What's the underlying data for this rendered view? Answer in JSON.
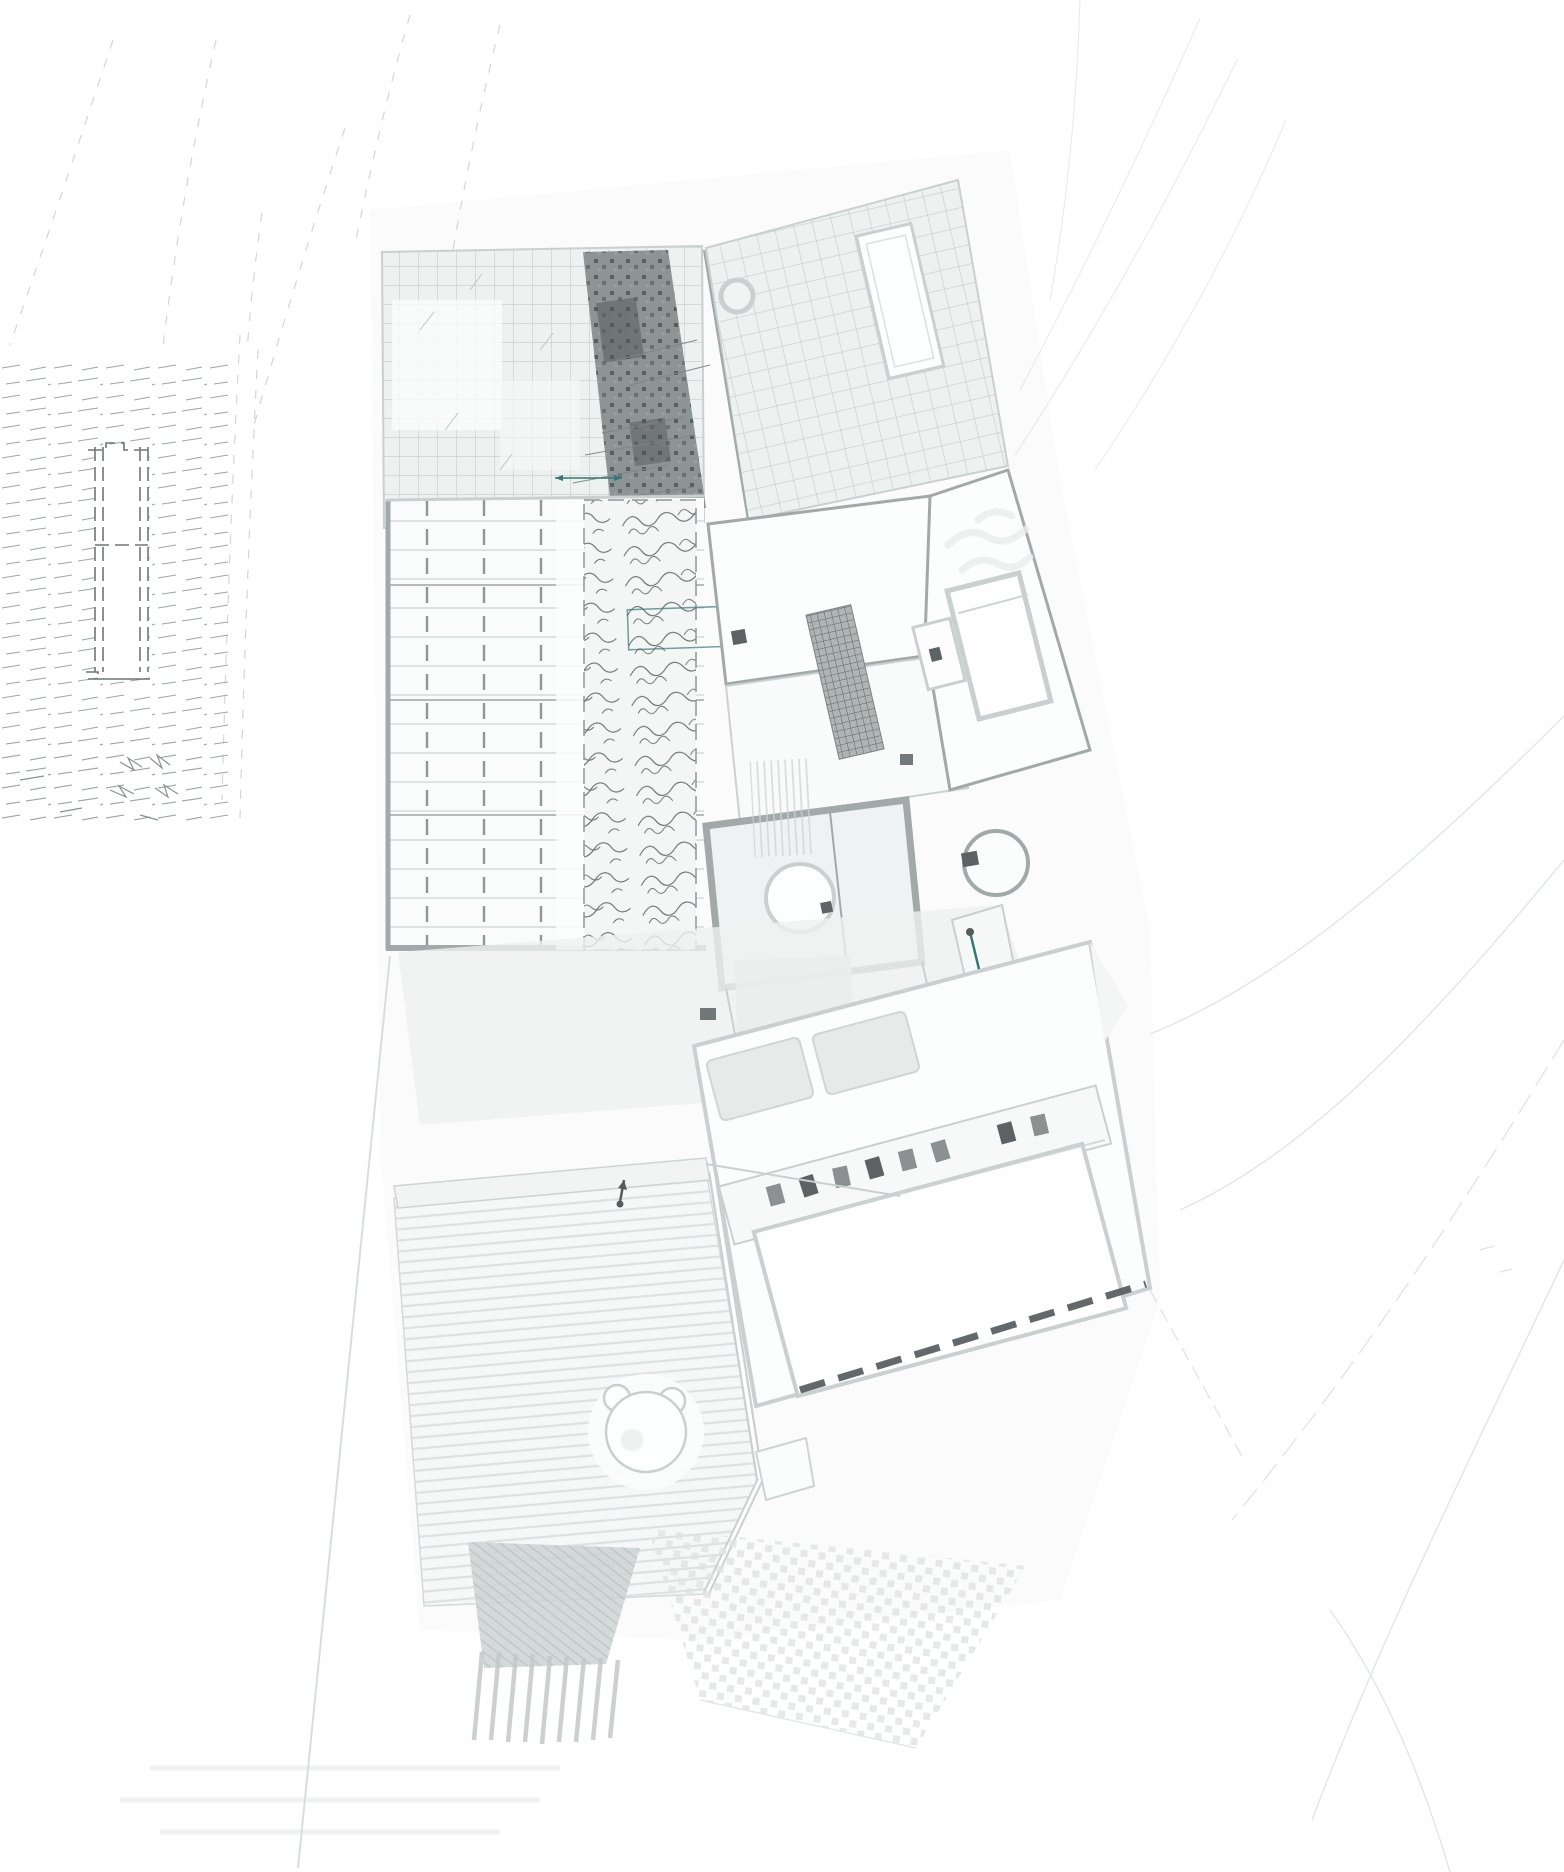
{
  "drawing": {
    "kind": "architectural-site-and-floor-plan",
    "markers": {
      "measure_arrow": "double-headed-arrow",
      "stair_direction_arrow": "arrow-with-end-dots",
      "entry_arrow": "small-up-arrow"
    }
  },
  "colors": {
    "paper": "#ffffff",
    "wash": "#f6f8f7",
    "terrace_wash": "#eef1f0",
    "contour": "#c3c9c8",
    "contour_faint": "#d9dedd",
    "tile_fill": "#edf1f0",
    "tile_line": "#c5cdcc",
    "wall": "#a2aaa9",
    "wall_light": "#c9d0cf",
    "room_fill": "#fcfdfd",
    "plants_dark": "#8d9496",
    "plants_speckle": "#4e5456",
    "scribble": "#5d6365",
    "pergola_line": "#ccd3d2",
    "pergola_dash": "#8f9796",
    "hatch_row": "#9fa6a5",
    "dash_dark": "#565c5e",
    "teal": "#2f7a74",
    "deck_stripe": "#dce2e1",
    "shade": "#e9edec",
    "item_dark": "#5d6364",
    "item_gray": "#8a9190",
    "paving_dot": "#dfe4e3",
    "grate_bg": "#aeb5b4",
    "grate_line": "#5f6665",
    "stair_line": "#c2c9c8",
    "wedge_fill": "#ccd3d2"
  }
}
